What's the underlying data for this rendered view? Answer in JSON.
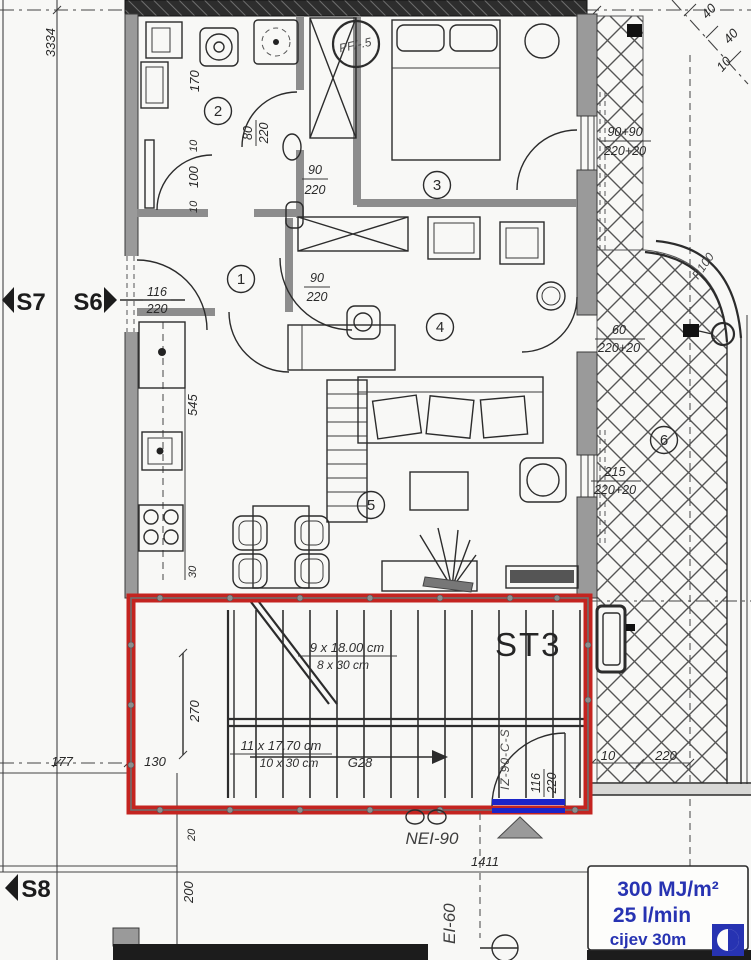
{
  "drawing": {
    "kind": "apartment floor plan with fire-escape staircase",
    "rooms": [
      {
        "n": "1"
      },
      {
        "n": "2"
      },
      {
        "n": "3"
      },
      {
        "n": "4"
      },
      {
        "n": "5"
      },
      {
        "n": "6"
      }
    ],
    "sections": {
      "s7": "S7",
      "s6": "S6",
      "s8": "S8"
    },
    "stair": {
      "name": "ST3",
      "flight1_risers": "9 x 18.00 cm",
      "flight1_treads": "8 x 30 cm",
      "flight2_risers": "11 x 17.70 cm",
      "flight2_treads": "10 x 30 cm",
      "code": "G28",
      "well_width": "270"
    },
    "dims": {
      "left_total": "3334",
      "k170": "170",
      "k10a": "10",
      "k100": "100",
      "k10b": "10",
      "k545": "545",
      "k30": "30",
      "k20": "20",
      "k200": "200",
      "k177": "177",
      "k130": "130",
      "k1411": "1411",
      "t10": "10",
      "t220": "220",
      "d40a": "40",
      "d40b": "40",
      "d10": "10"
    },
    "doors": {
      "entry": {
        "num": "116",
        "den": "220"
      },
      "bath": {
        "num": "80",
        "den": "220"
      },
      "hall_a": {
        "num": "90",
        "den": "220"
      },
      "hall_b": {
        "num": "90",
        "den": "220"
      },
      "stair": {
        "num": "116",
        "den": "220"
      }
    },
    "windows": {
      "w1": {
        "num": "90+90",
        "den": "220+20"
      },
      "w2": {
        "num": "60",
        "den": "220+20"
      },
      "w3": {
        "num": "215",
        "den": "220+20"
      }
    },
    "fire": {
      "wall_rating": "NEI-90",
      "shaft_rating": "EI-60",
      "door_spec": "IZ-90-C-S"
    },
    "radius_label": "R100",
    "sketch_note": "PF/-.5",
    "fire_load": {
      "line1": "300 MJ/m²",
      "line2": "25 l/min",
      "line3": "cijev 30m"
    },
    "colors": {
      "highlight_red": "#c42420",
      "highlight_blue": "#1b24c8",
      "info_blue": "#2733b2",
      "paper": "#f8f8f6"
    }
  }
}
